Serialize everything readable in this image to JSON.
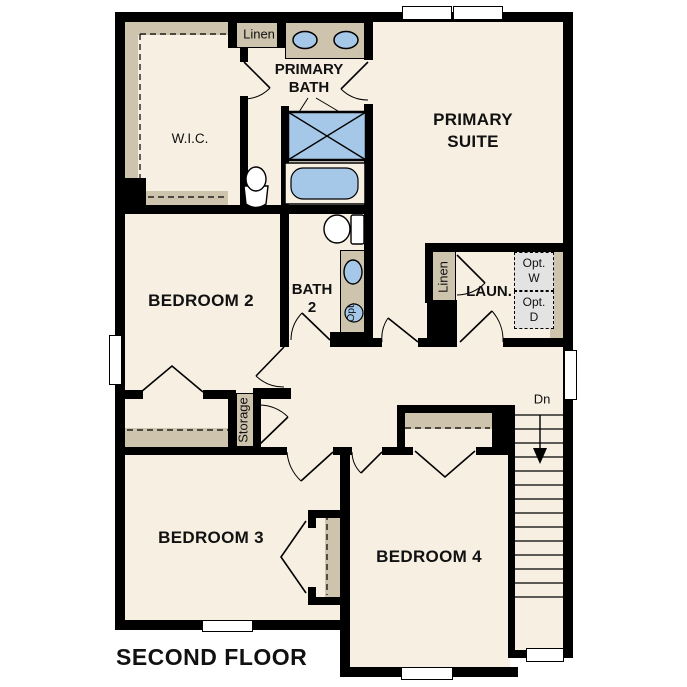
{
  "title": "SECOND FLOOR",
  "colors": {
    "floor": "#f6efe2",
    "wall": "#000000",
    "casework": "#cec3ad",
    "fixture": "#a5c8e9",
    "optbox": "#e3e3e3"
  },
  "rooms": {
    "wic": {
      "label": "W.I.C."
    },
    "linen_upper": {
      "label": "Linen"
    },
    "primary_bath": {
      "line1": "PRIMARY",
      "line2": "BATH"
    },
    "primary_suite": {
      "line1": "PRIMARY",
      "line2": "SUITE"
    },
    "bedroom2": {
      "label": "BEDROOM 2"
    },
    "bath2": {
      "line1": "BATH",
      "line2": "2",
      "optional_fixture": "Opt."
    },
    "laundry": {
      "label": "LAUN.",
      "linen": "Linen",
      "opt_washer": {
        "line1": "Opt.",
        "line2": "W"
      },
      "opt_dryer": {
        "line1": "Opt.",
        "line2": "D"
      }
    },
    "storage": {
      "label": "Storage"
    },
    "stairs": {
      "down_label": "Dn"
    },
    "bedroom3": {
      "label": "BEDROOM 3"
    },
    "bedroom4": {
      "label": "BEDROOM 4"
    }
  }
}
